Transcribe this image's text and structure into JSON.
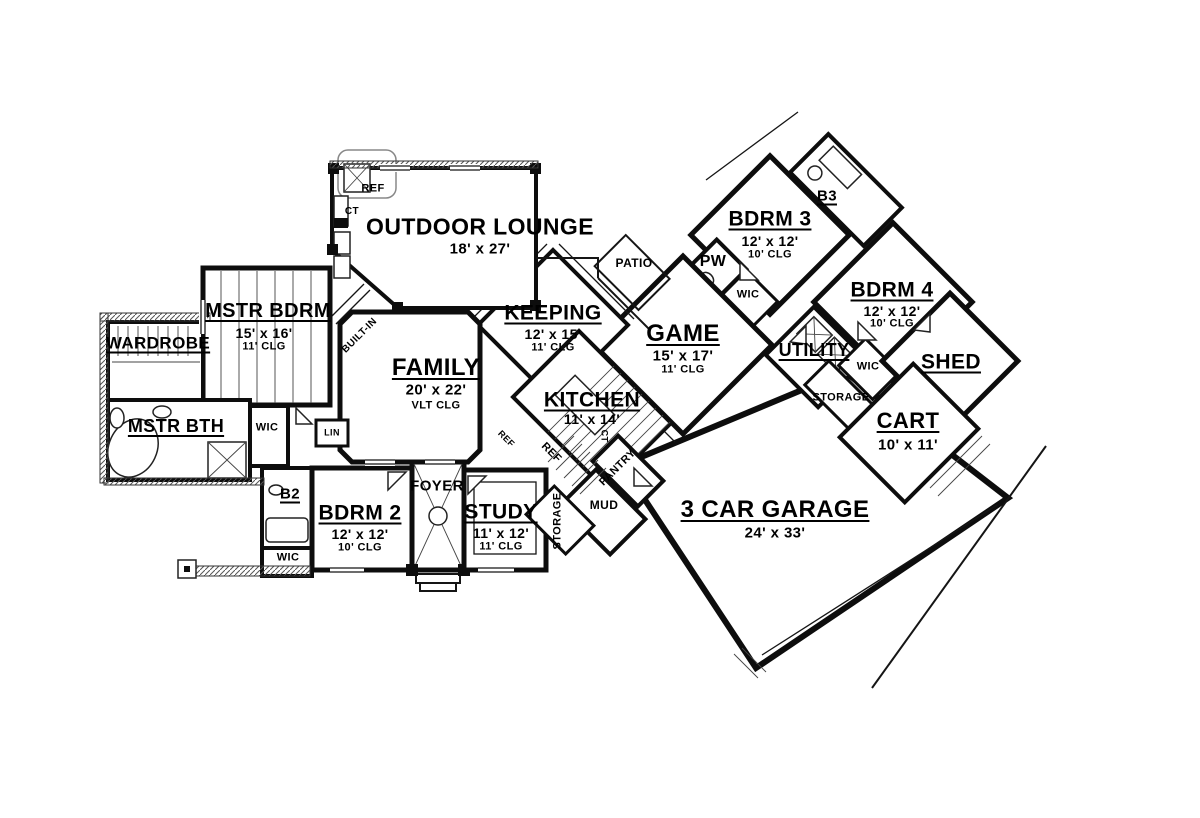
{
  "meta": {
    "type": "residential floor plan",
    "style": "black and white architectural line drawing",
    "wall_color": "#0d0d0d",
    "background_color": "#ffffff"
  },
  "rooms": {
    "outdoor_lounge": {
      "name": "OUTDOOR LOUNGE",
      "dims": "18' x 27'"
    },
    "mstr_bdrm": {
      "name": "MSTR BDRM",
      "dims": "15' x 16'",
      "clg": "11' CLG"
    },
    "wardrobe": {
      "name": "WARDROBE"
    },
    "mstr_bth": {
      "name": "MSTR BTH"
    },
    "b2": {
      "name": "B2"
    },
    "bdrm2": {
      "name": "BDRM 2",
      "dims": "12' x 12'",
      "clg": "10' CLG"
    },
    "foyer": {
      "name": "FOYER"
    },
    "study": {
      "name": "STUDY",
      "dims": "11' x 12'",
      "clg": "11' CLG"
    },
    "family": {
      "name": "FAMILY",
      "dims": "20' x 22'",
      "clg": "VLT CLG"
    },
    "keeping": {
      "name": "KEEPING",
      "dims": "12' x 15'",
      "clg": "11' CLG"
    },
    "kitchen": {
      "name": "KITCHEN",
      "dims": "11' x 14'"
    },
    "pantry": {
      "name": "PANTRY"
    },
    "mud": {
      "name": "MUD"
    },
    "garage": {
      "name": "3 CAR GARAGE",
      "dims": "24' x 33'"
    },
    "game": {
      "name": "GAME",
      "dims": "15' x 17'",
      "clg": "11' CLG"
    },
    "patio": {
      "name": "PATIO"
    },
    "pw": {
      "name": "PW"
    },
    "bdrm3": {
      "name": "BDRM 3",
      "dims": "12' x 12'",
      "clg": "10' CLG"
    },
    "b3": {
      "name": "B3"
    },
    "bdrm4": {
      "name": "BDRM 4",
      "dims": "12' x 12'",
      "clg": "10' CLG"
    },
    "utility": {
      "name": "UTILITY"
    },
    "shed": {
      "name": "SHED"
    },
    "cart": {
      "name": "CART",
      "dims": "10' x 11'"
    }
  },
  "annotations": {
    "built_in": "BUILT-IN",
    "wic": "WIC",
    "lin": "LIN",
    "storage": "STORAGE",
    "ref": "REF",
    "ct": "CT"
  }
}
